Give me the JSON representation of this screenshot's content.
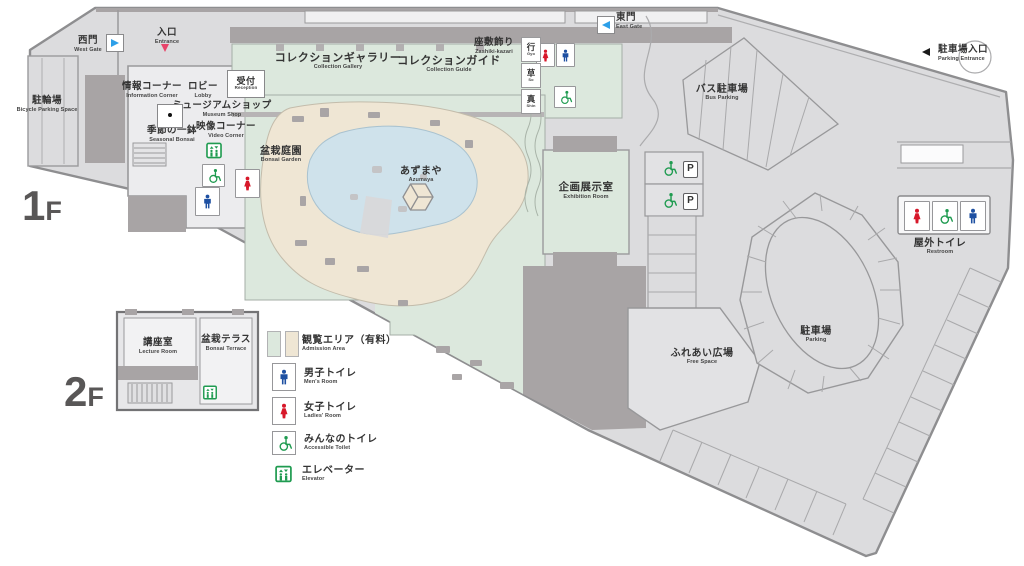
{
  "colors": {
    "ground": "#dcdcde",
    "outline": "#8e8e90",
    "building_dark": "#a8a4a5",
    "interior_light": "#ececee",
    "admission_green": "#dce8dd",
    "garden_beige": "#efe6d4",
    "pond_blue": "#cfe2eb",
    "icon_green": "#1f9b50",
    "icon_blue": "#1e50a2",
    "icon_red": "#d7182a",
    "gate_arrow_blue": "#2d9fe8",
    "entrance_arrow_red": "#e8446a",
    "floor_label_gray": "#595757"
  },
  "floors": {
    "f1_num": "1",
    "f1_suffix": "F",
    "f2_num": "2",
    "f2_suffix": "F"
  },
  "map": {
    "west_gate": {
      "jp": "西門",
      "en": "West Gate"
    },
    "entrance": {
      "jp": "入口",
      "en": "Entrance"
    },
    "east_gate": {
      "jp": "東門",
      "en": "East Gate"
    },
    "bicycle_parking": {
      "jp": "駐輪場",
      "en": "Bicycle Parking Space"
    },
    "info_corner": {
      "jp": "情報コーナー",
      "en": "Information Corner"
    },
    "lobby": {
      "jp": "ロビー",
      "en": "Lobby"
    },
    "reception": {
      "jp": "受付",
      "en": "Reception"
    },
    "museum_shop": {
      "jp": "ミュージアムショップ",
      "en": "Museum Shop"
    },
    "seasonal_bonsai": {
      "jp": "季節の一鉢",
      "en": "Seasonal Bonsai"
    },
    "video_corner": {
      "jp": "映像コーナー",
      "en": "Video Corner"
    },
    "collection_gallery": {
      "jp": "コレクションギャラリー",
      "en": "Collection Gallery"
    },
    "collection_guide": {
      "jp": "コレクションガイド",
      "en": "Collection Guide"
    },
    "zashiki_kazari": {
      "jp": "座敷飾り",
      "en": "Zashiki-kazari"
    },
    "room_gyo": {
      "jp": "行",
      "en": "Gyo"
    },
    "room_so": {
      "jp": "草",
      "en": "So"
    },
    "room_shin": {
      "jp": "真",
      "en": "Shin"
    },
    "bus_parking": {
      "jp": "バス駐車場",
      "en": "Bus Parking"
    },
    "bonsai_garden": {
      "jp": "盆栽庭園",
      "en": "Bonsai Garden"
    },
    "azumaya": {
      "jp": "あずまや",
      "en": "Azumaya"
    },
    "exhibition_room": {
      "jp": "企画展示室",
      "en": "Exhibition Room"
    },
    "parking_entrance": {
      "jp": "駐車場入口",
      "en": "Parking Entrance"
    },
    "outdoor_toilet": {
      "jp": "屋外トイレ",
      "en": "Restroom"
    },
    "parking": {
      "jp": "駐車場",
      "en": "Parking"
    },
    "free_space": {
      "jp": "ふれあい広場",
      "en": "Free Space"
    },
    "lecture_room": {
      "jp": "講座室",
      "en": "Lecture Room"
    },
    "bonsai_terrace": {
      "jp": "盆栽テラス",
      "en": "Bonsai Terrace"
    },
    "p_label": "P"
  },
  "legend": {
    "admission": {
      "jp": "観覧エリア（有料）",
      "en": "Admission Area"
    },
    "mens": {
      "jp": "男子トイレ",
      "en": "Men's Room"
    },
    "ladies": {
      "jp": "女子トイレ",
      "en": "Ladies' Room"
    },
    "accessible": {
      "jp": "みんなのトイレ",
      "en": "Accessible Toilet"
    },
    "elevator": {
      "jp": "エレベーター",
      "en": "Elevator"
    }
  }
}
